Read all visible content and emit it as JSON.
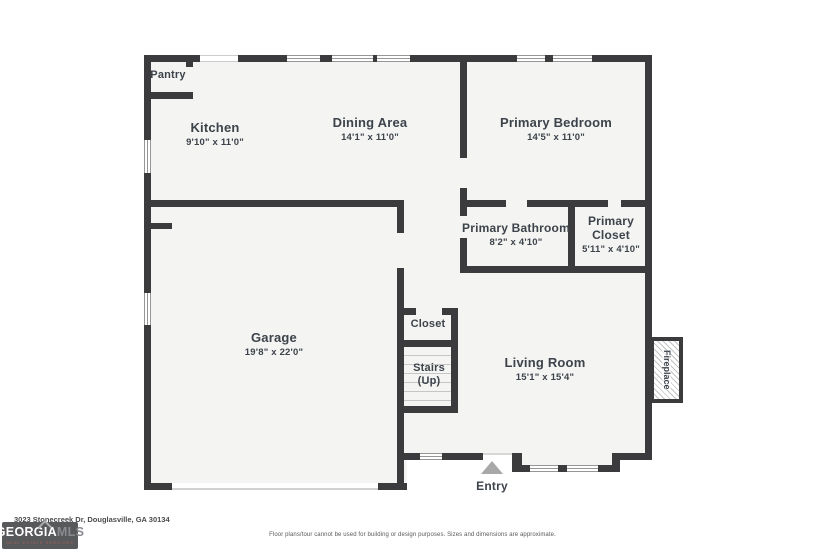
{
  "plan": {
    "rooms": {
      "pantry": {
        "name": "Pantry"
      },
      "kitchen": {
        "name": "Kitchen",
        "dims": "9'10\" x 11'0\""
      },
      "dining": {
        "name": "Dining Area",
        "dims": "14'1\" x 11'0\""
      },
      "primary_bedroom": {
        "name": "Primary Bedroom",
        "dims": "14'5\" x 11'0\""
      },
      "primary_bathroom": {
        "name": "Primary Bathroom",
        "dims": "8'2\" x 4'10\""
      },
      "primary_closet": {
        "name": "Primary Closet",
        "dims": "5'11\" x 4'10\""
      },
      "garage": {
        "name": "Garage",
        "dims": "19'8\" x 22'0\""
      },
      "closet": {
        "name": "Closet"
      },
      "stairs": {
        "name": "Stairs",
        "sub": "(Up)"
      },
      "living_room": {
        "name": "Living Room",
        "dims": "15'1\" x 15'4\""
      }
    },
    "features": {
      "fireplace": "Fireplace",
      "entry": "Entry"
    }
  },
  "footer": {
    "address": "3023 Stonecreek Dr, Douglasville, GA 30134",
    "disclaimer": "Floor plans/tour cannot be used for building or design purposes. Sizes and dimensions are approximate.",
    "logo": {
      "brand_primary": "GEORGIA",
      "brand_secondary": "MLS",
      "tagline": "REAL ESTATE SERVICES"
    }
  },
  "colors": {
    "wall": "#3b3b3d",
    "floor": "#f4f4f2",
    "label": "#3d434b",
    "arrow": "#a8a8a8",
    "logo_bg": "#58595b",
    "logo_secondary": "#898b8e",
    "logo_tagline": "#a8625a"
  }
}
